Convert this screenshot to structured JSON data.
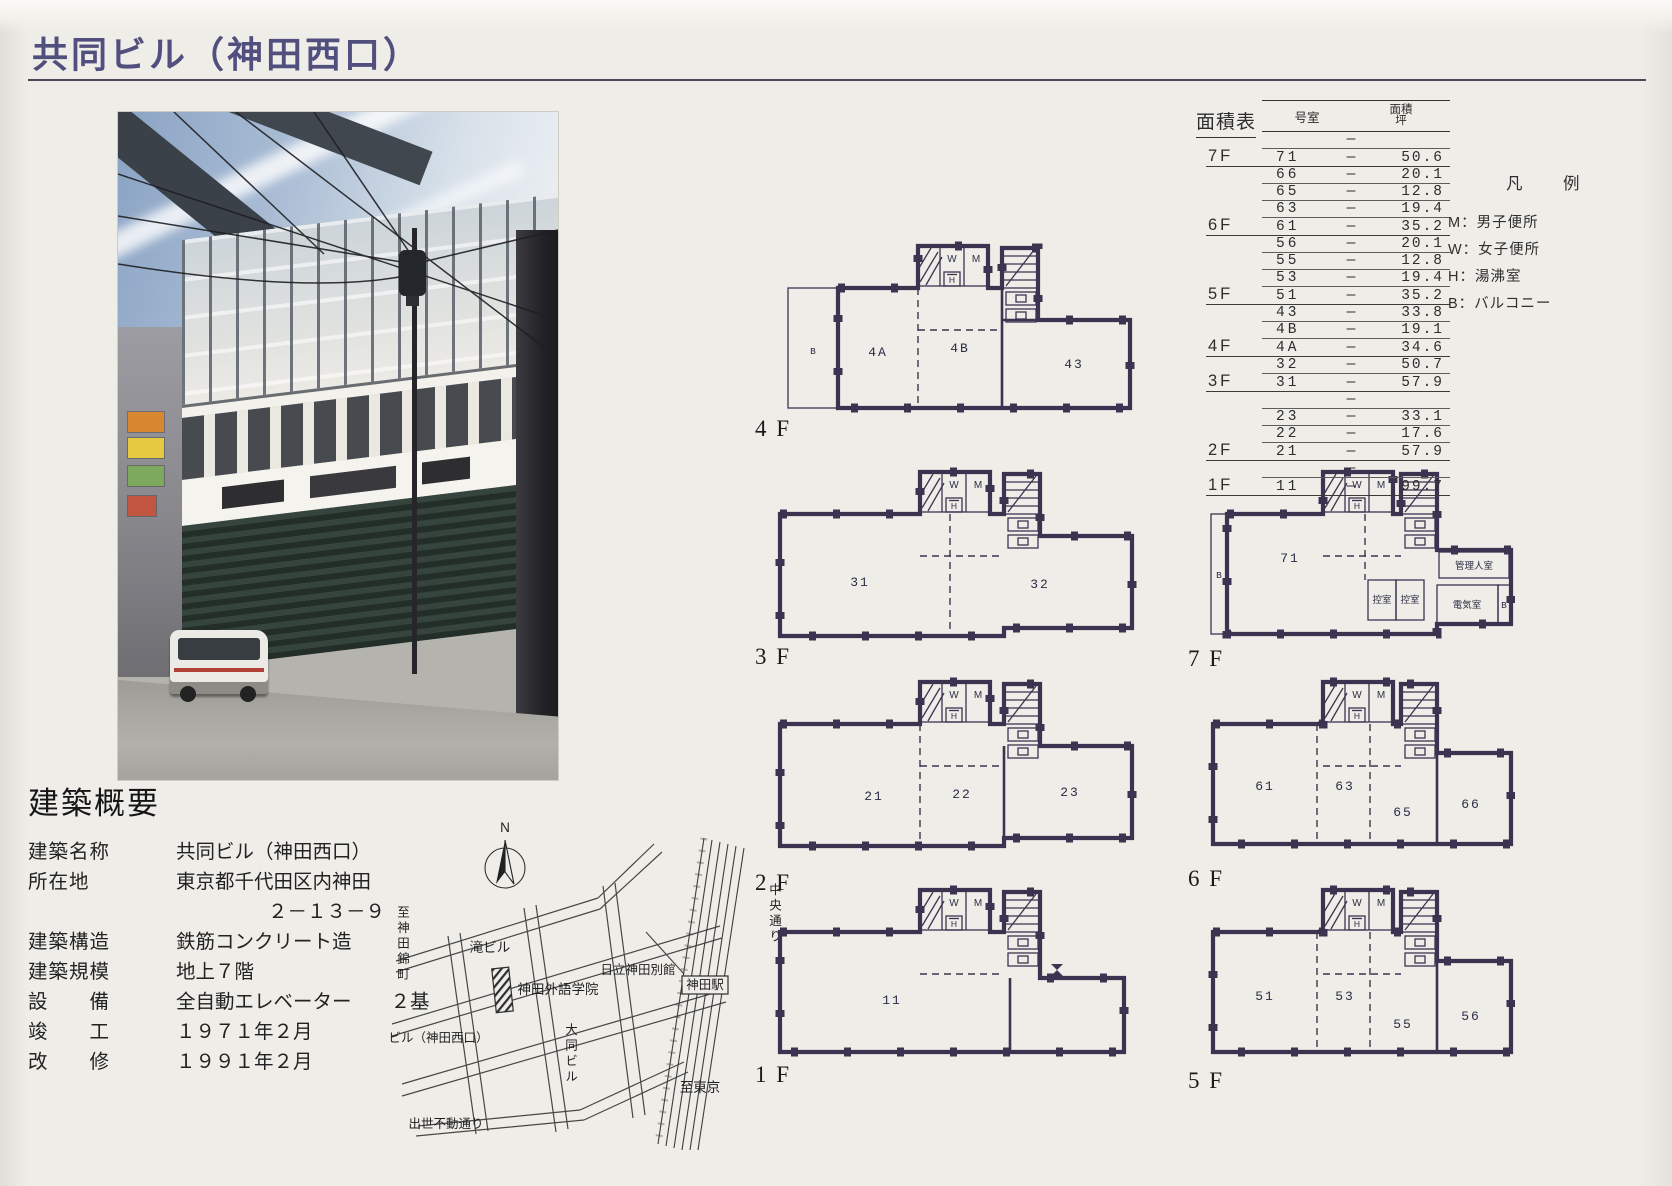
{
  "page": {
    "title": "共同ビル（神田西口）"
  },
  "colors": {
    "title_ink": "#514f7d",
    "plan_wall": "#3b3450",
    "paper": "#efede8"
  },
  "overview": {
    "heading": "建築概要",
    "fields": [
      {
        "label": "建築名称",
        "value": "共同ビル（神田西口）"
      },
      {
        "label": "所在地",
        "value": "東京都千代田区内神田",
        "value2": "２－１３－９"
      },
      {
        "label": "建築構造",
        "value": "鉄筋コンクリート造"
      },
      {
        "label": "建築規模",
        "value": "地上７階"
      },
      {
        "label": "設　　備",
        "value": "全自動エレベーター　　２基"
      },
      {
        "label": "竣　　工",
        "value": "１９７１年２月"
      },
      {
        "label": "改　　修",
        "value": "１９９１年２月"
      }
    ]
  },
  "area_table": {
    "title": "面積表",
    "col_room": "号室",
    "col_area": "面積",
    "col_area_unit": "坪",
    "dash": "—",
    "groups": [
      {
        "floor": "7F",
        "rows": [
          {
            "room": "",
            "area": ""
          },
          {
            "room": "71",
            "area": "50.6"
          }
        ]
      },
      {
        "floor": "6F",
        "rows": [
          {
            "room": "66",
            "area": "20.1"
          },
          {
            "room": "65",
            "area": "12.8"
          },
          {
            "room": "63",
            "area": "19.4"
          },
          {
            "room": "61",
            "area": "35.2"
          }
        ]
      },
      {
        "floor": "5F",
        "rows": [
          {
            "room": "56",
            "area": "20.1"
          },
          {
            "room": "55",
            "area": "12.8"
          },
          {
            "room": "53",
            "area": "19.4"
          },
          {
            "room": "51",
            "area": "35.2"
          }
        ]
      },
      {
        "floor": "4F",
        "rows": [
          {
            "room": "43",
            "area": "33.8"
          },
          {
            "room": "4B",
            "area": "19.1"
          },
          {
            "room": "4A",
            "area": "34.6"
          }
        ]
      },
      {
        "floor": "3F",
        "rows": [
          {
            "room": "32",
            "area": "50.7"
          },
          {
            "room": "31",
            "area": "57.9"
          }
        ]
      },
      {
        "floor": "2F",
        "rows": [
          {
            "room": "",
            "area": ""
          },
          {
            "room": "23",
            "area": "33.1"
          },
          {
            "room": "22",
            "area": "17.6"
          },
          {
            "room": "21",
            "area": "57.9"
          }
        ]
      },
      {
        "floor": "1F",
        "rows": [
          {
            "room": "",
            "area": ""
          },
          {
            "room": "11",
            "area": "99.7"
          }
        ]
      }
    ]
  },
  "legend": {
    "title": "凡　例",
    "separator": "：",
    "items": [
      {
        "key": "M",
        "label": "男子便所"
      },
      {
        "key": "W",
        "label": "女子便所"
      },
      {
        "key": "H",
        "label": "湯沸室"
      },
      {
        "key": "B",
        "label": "バルコニー"
      }
    ]
  },
  "map": {
    "compass": "N",
    "labels": {
      "taki_building": "滝ビル",
      "kanda_gaigo": "神田外語学院",
      "hitachi_annex": "日立神田別館",
      "kanda_station": "神田駅",
      "kyodo_building": "共同ビル（神田西口）",
      "daido_building": "大同ビル",
      "shusse_fudo_street": "出世不動通り",
      "to_tokyo": "至東京",
      "to_kanda_nishikicho": "至神田錦町",
      "chuo_street": "中央通り"
    }
  },
  "plan_core": {
    "w": "W",
    "m": "M",
    "h": "H"
  },
  "floor_plans": [
    {
      "id": "4f",
      "label": "4 F",
      "rooms": [
        "B",
        "4A",
        "4B",
        "43"
      ]
    },
    {
      "id": "3f",
      "label": "3 F",
      "rooms": [
        "31",
        "32"
      ]
    },
    {
      "id": "2f",
      "label": "2 F",
      "rooms": [
        "21",
        "22",
        "23"
      ]
    },
    {
      "id": "1f",
      "label": "1 F",
      "rooms": [
        "11"
      ]
    },
    {
      "id": "7f",
      "label": "7 F",
      "rooms": [
        "B",
        "71",
        "管理人室",
        "控室",
        "控室",
        "電気室",
        "B"
      ]
    },
    {
      "id": "6f",
      "label": "6 F",
      "rooms": [
        "61",
        "63",
        "65",
        "66"
      ]
    },
    {
      "id": "5f",
      "label": "5 F",
      "rooms": [
        "51",
        "53",
        "55",
        "56"
      ]
    }
  ]
}
